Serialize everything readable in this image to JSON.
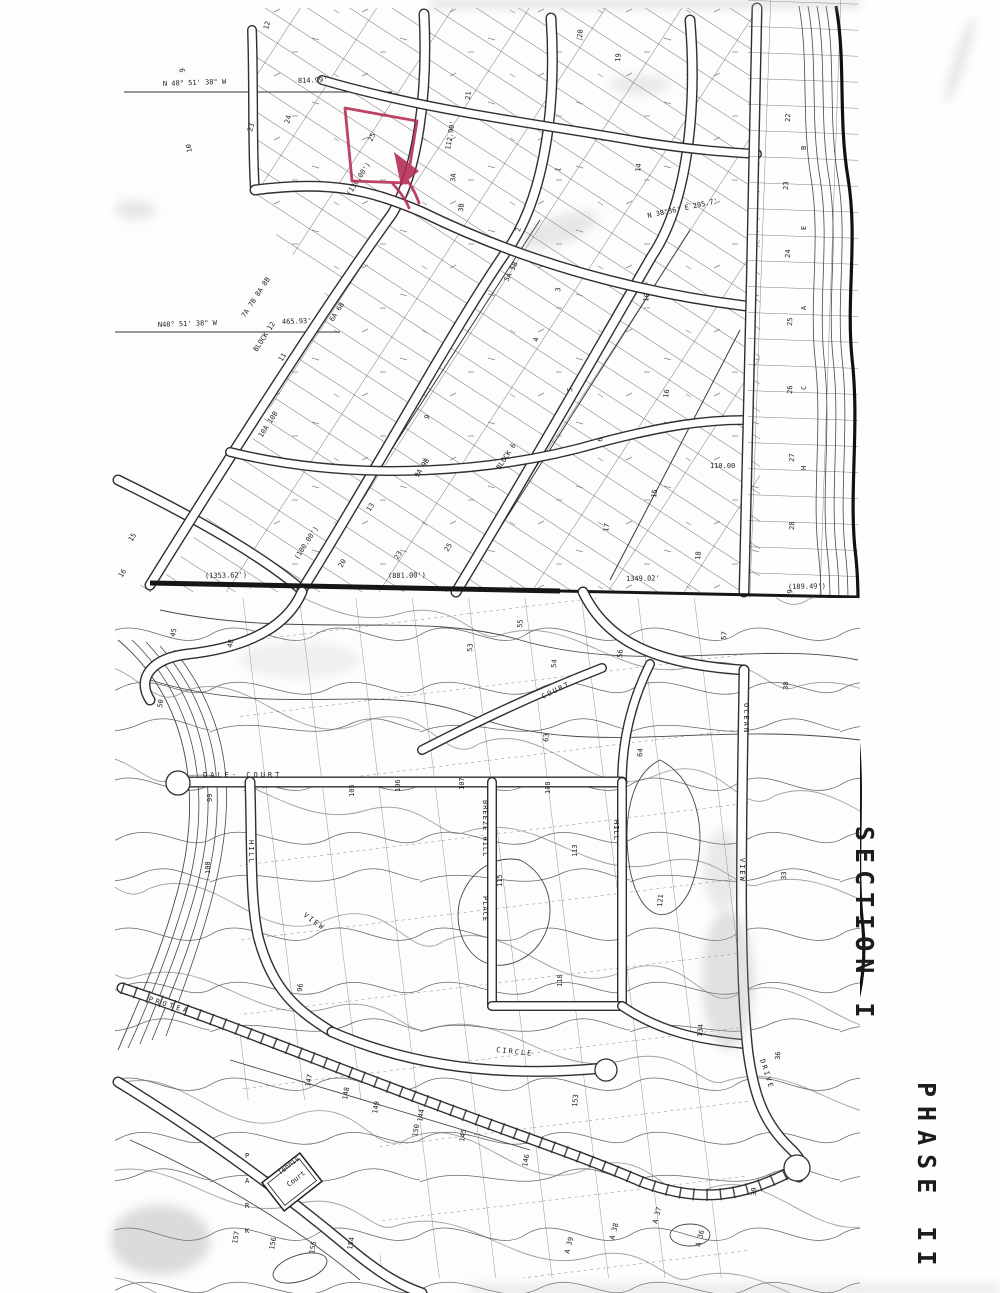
{
  "annotations": {
    "section_label": "SECTION I",
    "phase_label": "PHASE II",
    "marker_color": "#b32a52"
  },
  "map": {
    "street_labels": [
      {
        "t": "DALE- COURT",
        "x": 203,
        "y": 777,
        "r": 0,
        "s": 9,
        "ls": 3
      },
      {
        "t": "HILL",
        "x": 249,
        "y": 840,
        "r": 90,
        "s": 8,
        "ls": 2
      },
      {
        "t": "VIEW",
        "x": 303,
        "y": 916,
        "r": 36,
        "s": 8,
        "ls": 2
      },
      {
        "t": "CIRCLE",
        "x": 496,
        "y": 1052,
        "r": 6,
        "s": 8,
        "ls": 2
      },
      {
        "t": "BREEZE HILL",
        "x": 483,
        "y": 800,
        "r": 90,
        "s": 6.5,
        "ls": 1
      },
      {
        "t": "PLACE",
        "x": 483,
        "y": 896,
        "r": 90,
        "s": 6.5,
        "ls": 1
      },
      {
        "t": "HILL",
        "x": 614,
        "y": 820,
        "r": 90,
        "s": 7,
        "ls": 1
      },
      {
        "t": "OCEAN",
        "x": 744,
        "y": 703,
        "r": 90,
        "s": 8,
        "ls": 2
      },
      {
        "t": "VIEW",
        "x": 740,
        "y": 858,
        "r": 90,
        "s": 8,
        "ls": 2
      },
      {
        "t": "DRIVE",
        "x": 760,
        "y": 1060,
        "r": 72,
        "s": 8,
        "ls": 2
      },
      {
        "t": "PROTEA",
        "x": 148,
        "y": 1001,
        "r": 17,
        "s": 9,
        "ls": 3
      },
      {
        "t": "COURT",
        "x": 543,
        "y": 699,
        "r": -26,
        "s": 7,
        "ls": 2
      },
      {
        "t": "P",
        "x": 245,
        "y": 1158,
        "r": 0,
        "s": 11
      },
      {
        "t": "A",
        "x": 245,
        "y": 1183,
        "r": 0,
        "s": 11
      },
      {
        "t": "R",
        "x": 245,
        "y": 1208,
        "r": 0,
        "s": 11
      },
      {
        "t": "K",
        "x": 245,
        "y": 1233,
        "r": 0,
        "s": 11
      },
      {
        "t": "Tennis",
        "x": 280,
        "y": 1175,
        "r": -38,
        "s": 7
      },
      {
        "t": "Court",
        "x": 289,
        "y": 1187,
        "r": -38,
        "s": 7
      }
    ],
    "block_labels": [
      {
        "t": "7A 7B 8A 8B",
        "x": 245,
        "y": 318,
        "r": -57,
        "s": 7.5
      },
      {
        "t": "BLOCK 12",
        "x": 257,
        "y": 352,
        "r": -57,
        "s": 7.5
      },
      {
        "t": "6A 6B",
        "x": 333,
        "y": 322,
        "r": -57,
        "s": 7.5
      },
      {
        "t": "10A 10B",
        "x": 262,
        "y": 438,
        "r": -57,
        "s": 7.5
      },
      {
        "t": "9A 9B",
        "x": 418,
        "y": 478,
        "r": -57,
        "s": 7.5
      },
      {
        "t": "BLOCK 6",
        "x": 500,
        "y": 470,
        "r": -57,
        "s": 7.5
      },
      {
        "t": "B",
        "x": 806,
        "y": 150,
        "r": -90,
        "s": 8
      },
      {
        "t": "E",
        "x": 806,
        "y": 230,
        "r": -90,
        "s": 8
      },
      {
        "t": "A",
        "x": 806,
        "y": 310,
        "r": -90,
        "s": 8
      },
      {
        "t": "C",
        "x": 806,
        "y": 390,
        "r": -90,
        "s": 8
      },
      {
        "t": "H",
        "x": 806,
        "y": 470,
        "r": -90,
        "s": 8
      }
    ],
    "bearing_labels": [
      {
        "t": "N 48° 51' 38\" W",
        "x": 163,
        "y": 86,
        "r": -2,
        "s": 6.3
      },
      {
        "t": "814.99'",
        "x": 298,
        "y": 83,
        "r": -2,
        "s": 6.3
      },
      {
        "t": "N48° 51' 38\" W",
        "x": 158,
        "y": 327,
        "r": -2,
        "s": 6.3
      },
      {
        "t": "465.93'",
        "x": 282,
        "y": 324,
        "r": -2,
        "s": 6.3
      },
      {
        "t": "(1353.62')",
        "x": 205,
        "y": 578,
        "r": -1,
        "s": 6.3
      },
      {
        "t": "(881.00')",
        "x": 388,
        "y": 578,
        "r": -1,
        "s": 6.3
      },
      {
        "t": "1349.02'",
        "x": 626,
        "y": 581,
        "r": -1,
        "s": 6.3
      },
      {
        "t": "(189.49')",
        "x": 788,
        "y": 589,
        "r": -1,
        "s": 6.3
      },
      {
        "t": "(130.00')",
        "x": 350,
        "y": 196,
        "r": -57,
        "s": 5.5
      },
      {
        "t": "(100.00')",
        "x": 298,
        "y": 560,
        "r": -57,
        "s": 5.5
      },
      {
        "t": "112.90'",
        "x": 450,
        "y": 150,
        "r": -80,
        "s": 5.5
      },
      {
        "t": "110.00",
        "x": 710,
        "y": 468,
        "r": 0,
        "s": 5.5
      },
      {
        "t": "N 38°36' E  295.7'",
        "x": 648,
        "y": 218,
        "r": -12,
        "s": 5.5
      }
    ],
    "lot_numbers": [
      {
        "t": "9",
        "x": 185,
        "y": 72,
        "r": -100
      },
      {
        "t": "10",
        "x": 192,
        "y": 152,
        "r": -100
      },
      {
        "t": "12",
        "x": 268,
        "y": 30,
        "r": -75
      },
      {
        "t": "23",
        "x": 252,
        "y": 132,
        "r": -75
      },
      {
        "t": "24",
        "x": 289,
        "y": 124,
        "r": -75
      },
      {
        "t": "25",
        "x": 372,
        "y": 142,
        "r": -65
      },
      {
        "t": "21",
        "x": 470,
        "y": 100,
        "r": -85
      },
      {
        "t": "3A",
        "x": 455,
        "y": 182,
        "r": -85
      },
      {
        "t": "3B",
        "x": 463,
        "y": 212,
        "r": -85
      },
      {
        "t": "2",
        "x": 520,
        "y": 232,
        "r": -80
      },
      {
        "t": "1",
        "x": 560,
        "y": 172,
        "r": -80
      },
      {
        "t": "5A 5B",
        "x": 508,
        "y": 282,
        "r": -62,
        "s": 6
      },
      {
        "t": "15",
        "x": 132,
        "y": 542,
        "r": -57
      },
      {
        "t": "16",
        "x": 122,
        "y": 578,
        "r": -57
      },
      {
        "t": "11",
        "x": 282,
        "y": 362,
        "r": -57
      },
      {
        "t": "13",
        "x": 370,
        "y": 512,
        "r": -57
      },
      {
        "t": "20",
        "x": 342,
        "y": 568,
        "r": -60
      },
      {
        "t": "23",
        "x": 398,
        "y": 560,
        "r": -60
      },
      {
        "t": "25",
        "x": 448,
        "y": 552,
        "r": -60
      },
      {
        "t": "9",
        "x": 428,
        "y": 420,
        "r": -60
      },
      {
        "t": "3",
        "x": 560,
        "y": 292,
        "r": -82
      },
      {
        "t": "4",
        "x": 538,
        "y": 342,
        "r": -82
      },
      {
        "t": "5",
        "x": 572,
        "y": 392,
        "r": -82
      },
      {
        "t": "6",
        "x": 602,
        "y": 442,
        "r": -82
      },
      {
        "t": "10",
        "x": 648,
        "y": 302,
        "r": -82
      },
      {
        "t": "14",
        "x": 640,
        "y": 172,
        "r": -82
      },
      {
        "t": "16",
        "x": 668,
        "y": 398,
        "r": -82
      },
      {
        "t": "15",
        "x": 656,
        "y": 498,
        "r": -82
      },
      {
        "t": "17",
        "x": 608,
        "y": 532,
        "r": -82
      },
      {
        "t": "19",
        "x": 620,
        "y": 62,
        "r": -85
      },
      {
        "t": "20",
        "x": 582,
        "y": 38,
        "r": -85
      },
      {
        "t": "18",
        "x": 700,
        "y": 560,
        "r": -85
      },
      {
        "t": "22",
        "x": 790,
        "y": 122,
        "r": -88
      },
      {
        "t": "23",
        "x": 788,
        "y": 190,
        "r": -88
      },
      {
        "t": "24",
        "x": 790,
        "y": 258,
        "r": -88
      },
      {
        "t": "25",
        "x": 792,
        "y": 326,
        "r": -88
      },
      {
        "t": "26",
        "x": 792,
        "y": 394,
        "r": -88
      },
      {
        "t": "27",
        "x": 794,
        "y": 462,
        "r": -88
      },
      {
        "t": "28",
        "x": 794,
        "y": 530,
        "r": -88
      },
      {
        "t": "29",
        "x": 792,
        "y": 598,
        "r": -88
      },
      {
        "t": "30",
        "x": 788,
        "y": 690,
        "r": -88
      },
      {
        "t": "33",
        "x": 786,
        "y": 880,
        "r": -88
      },
      {
        "t": "36",
        "x": 780,
        "y": 1060,
        "r": -88
      },
      {
        "t": "39",
        "x": 756,
        "y": 1196,
        "r": -88
      },
      {
        "t": "45",
        "x": 175,
        "y": 637,
        "r": -80
      },
      {
        "t": "48",
        "x": 232,
        "y": 648,
        "r": -80
      },
      {
        "t": "50",
        "x": 162,
        "y": 708,
        "r": -80
      },
      {
        "t": "53",
        "x": 472,
        "y": 652,
        "r": -85
      },
      {
        "t": "54",
        "x": 556,
        "y": 668,
        "r": -85
      },
      {
        "t": "55",
        "x": 522,
        "y": 628,
        "r": -85
      },
      {
        "t": "56",
        "x": 622,
        "y": 658,
        "r": -85
      },
      {
        "t": "57",
        "x": 726,
        "y": 640,
        "r": -85
      },
      {
        "t": "63",
        "x": 548,
        "y": 742,
        "r": -85
      },
      {
        "t": "64",
        "x": 642,
        "y": 757,
        "r": -85
      },
      {
        "t": "99",
        "x": 212,
        "y": 802,
        "r": -90
      },
      {
        "t": "100",
        "x": 210,
        "y": 874,
        "r": -90
      },
      {
        "t": "96",
        "x": 302,
        "y": 992,
        "r": -85
      },
      {
        "t": "105",
        "x": 354,
        "y": 797,
        "r": -90
      },
      {
        "t": "106",
        "x": 400,
        "y": 792,
        "r": -90
      },
      {
        "t": "107",
        "x": 464,
        "y": 790,
        "r": -90
      },
      {
        "t": "108",
        "x": 550,
        "y": 794,
        "r": -90
      },
      {
        "t": "113",
        "x": 577,
        "y": 857,
        "r": -90
      },
      {
        "t": "115",
        "x": 502,
        "y": 887,
        "r": -90
      },
      {
        "t": "118",
        "x": 562,
        "y": 987,
        "r": -90
      },
      {
        "t": "121",
        "x": 662,
        "y": 907,
        "r": -85
      },
      {
        "t": "134",
        "x": 702,
        "y": 1037,
        "r": -85
      },
      {
        "t": "144",
        "x": 422,
        "y": 1122,
        "r": -80
      },
      {
        "t": "145",
        "x": 464,
        "y": 1142,
        "r": -80
      },
      {
        "t": "146",
        "x": 527,
        "y": 1167,
        "r": -80
      },
      {
        "t": "147",
        "x": 310,
        "y": 1087,
        "r": -80
      },
      {
        "t": "148",
        "x": 347,
        "y": 1100,
        "r": -80
      },
      {
        "t": "149",
        "x": 377,
        "y": 1114,
        "r": -80
      },
      {
        "t": "150",
        "x": 417,
        "y": 1137,
        "r": -80
      },
      {
        "t": "153",
        "x": 577,
        "y": 1107,
        "r": -85
      },
      {
        "t": "154",
        "x": 352,
        "y": 1250,
        "r": -80
      },
      {
        "t": "155",
        "x": 314,
        "y": 1254,
        "r": -80
      },
      {
        "t": "156",
        "x": 274,
        "y": 1250,
        "r": -80
      },
      {
        "t": "157",
        "x": 237,
        "y": 1244,
        "r": -80
      },
      {
        "t": "A 37",
        "x": 657,
        "y": 1224,
        "r": -75,
        "s": 6.5
      },
      {
        "t": "A 38",
        "x": 614,
        "y": 1240,
        "r": -75,
        "s": 6.5
      },
      {
        "t": "A 39",
        "x": 569,
        "y": 1254,
        "r": -75,
        "s": 6.5
      },
      {
        "t": "A 36",
        "x": 700,
        "y": 1247,
        "r": -75,
        "s": 6.5
      }
    ]
  }
}
